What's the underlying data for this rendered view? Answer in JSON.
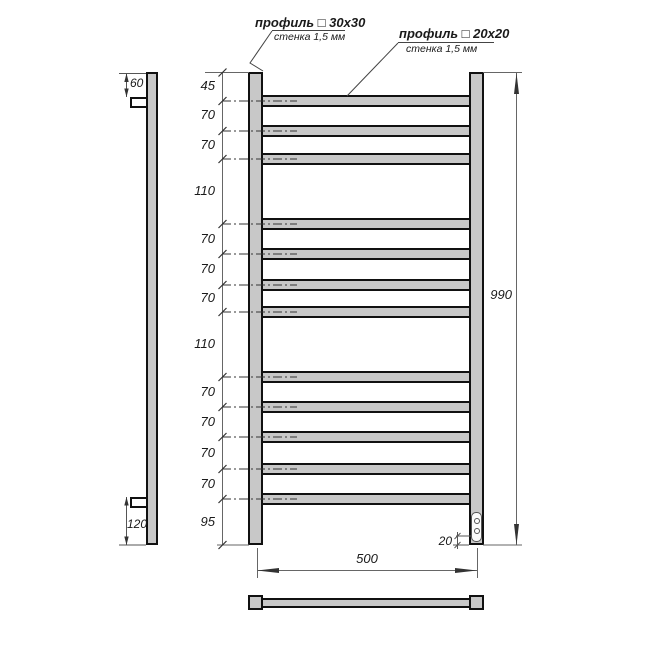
{
  "callouts": {
    "profile30": {
      "title": "профиль □ 30x30",
      "wall": "стенка 1,5 мм"
    },
    "profile20": {
      "title": "профиль □ 20x20",
      "wall": "стенка 1,5 мм"
    }
  },
  "dimensions": {
    "overall_height": "990",
    "overall_width": "500",
    "element_offset": "20",
    "bracket_top_offset": "60",
    "bracket_bottom_offset": "120",
    "left_spacings": [
      "45",
      "70",
      "70",
      "110",
      "70",
      "70",
      "70",
      "110",
      "70",
      "70",
      "70",
      "70",
      "95"
    ]
  },
  "colors": {
    "steel_fill": "#c8c8c8",
    "outline": "#111111",
    "dim_line": "#666666",
    "text": "#1a1a1a"
  }
}
